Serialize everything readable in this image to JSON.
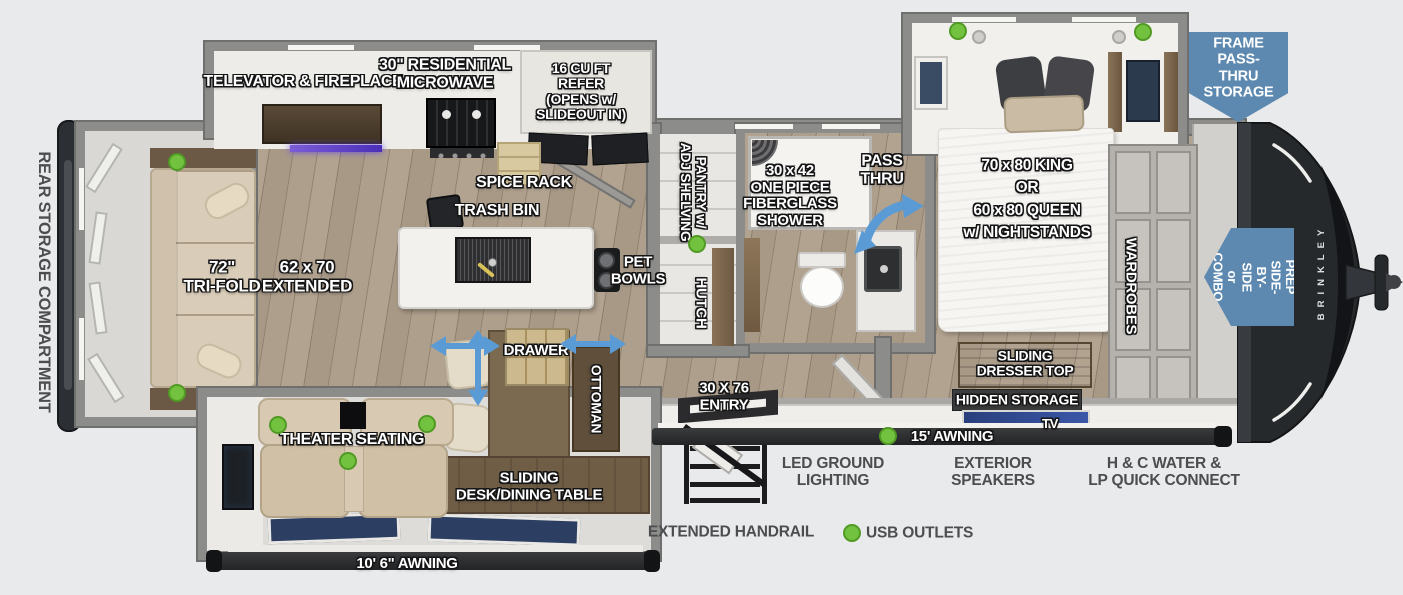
{
  "colors": {
    "usb_green": "#72c23f",
    "callout_blue": "#5d89b0",
    "arrow_blue": "#5b9bd5"
  },
  "brand": "BRINKLEY",
  "exterior": {
    "rear_storage": "REAR STORAGE COMPARTMENT",
    "awning_main": "15' AWNING",
    "awning_living": "10' 6\" AWNING",
    "entry": "30 X 76\nENTRY",
    "handrail": "EXTENDED HANDRAIL",
    "ground_lighting": "LED GROUND\nLIGHTING",
    "speakers": "EXTERIOR\nSPEAKERS",
    "water_lp": "H & C WATER &\nLP QUICK CONNECT",
    "usb": "USB OUTLETS"
  },
  "callouts": {
    "drop_frame": "DROP-FRAME\nPASS-THRU\nSTORAGE",
    "wd_prep": "W/D PREP\nSIDE-BY-SIDE\nor COMBO"
  },
  "kitchen": {
    "televator": "TELEVATOR & FIREPLACE",
    "microwave": "30\" RESIDENTIAL\nMICROWAVE",
    "refer": "16 CU FT\nREFER\n(OPENS w/\nSLIDEOUT IN)",
    "spice_rack": "SPICE RACK",
    "trash_bin": "TRASH BIN",
    "pet_bowls": "PET\nBOWLS",
    "pantry": "PANTRY w/\nADJ SHELVING",
    "hutch": "HUTCH"
  },
  "bath": {
    "shower": "30 x 42\nONE PIECE\nFIBERGLASS\nSHOWER",
    "pass_thru": "PASS\nTHRU"
  },
  "living": {
    "sofa": "72\"\nTRI-FOLD",
    "dinette": "62 x 70\nEXTENDED",
    "theater": "THEATER SEATING",
    "drawer": "DRAWER",
    "ottoman": "OTTOMAN",
    "table": "SLIDING\nDESK/DINING TABLE"
  },
  "bedroom": {
    "bed": "70 x 80 KING\nOR\n60 x 80 QUEEN\nw/ NIGHTSTANDS",
    "wardrobes": "WARDROBES",
    "dresser": "SLIDING\nDRESSER TOP",
    "hidden": "HIDDEN STORAGE",
    "tv": "TV"
  }
}
